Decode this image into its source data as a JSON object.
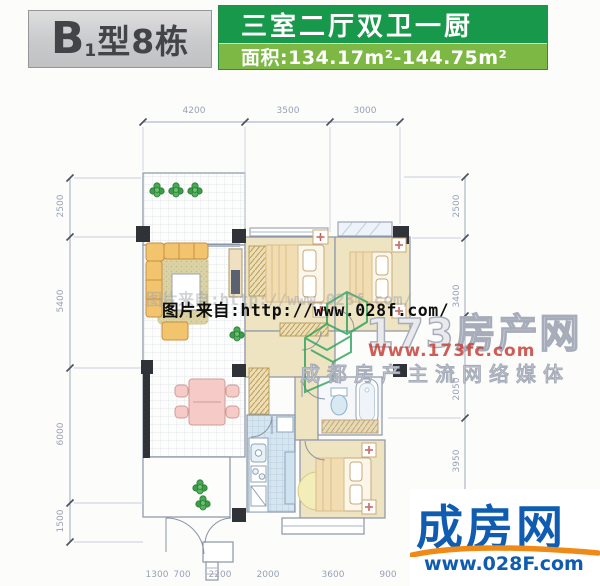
{
  "header": {
    "type_prefix": "B",
    "type_sub": "1",
    "type_suffix": "型8栋",
    "layout_title": "三室二厅双卫一厨",
    "area_label": "面积:134.17m²-144.75m²"
  },
  "dimensions": {
    "top": [
      "4200",
      "3500",
      "3000"
    ],
    "left": [
      "2500",
      "5400",
      "6000",
      "1500"
    ],
    "right": [
      "2500",
      "3400",
      "2050",
      "3950"
    ],
    "bottom": [
      "1300",
      "700",
      "2200",
      "2000",
      "3600",
      "900"
    ]
  },
  "watermarks": {
    "photo_source": "图片来自:http://www.028f.com/",
    "portal_name": "173房产网",
    "portal_url": "Www.173fc.com",
    "portal_slogan": "成都房产主流网络媒体"
  },
  "logo": {
    "name": "成房网",
    "url": "www.028F.com"
  },
  "colors": {
    "header_green_dark": "#18984b",
    "header_green_light": "#7cb843",
    "header_gray": "#c9cacc",
    "logo_blue": "#0f5cb0",
    "logo_orange": "#ef8a16",
    "watermark_red": "#c8413a",
    "watermark_green": "#2ca35c",
    "bedroom_floor": "#efe4c1",
    "kitchen_tile": "#d7e5f0",
    "wall_dark": "#2f3237"
  },
  "icons": {
    "plant": "green-circle-cluster",
    "nightstand_flower": "red-cross-flower",
    "column": "filled-black-square",
    "door": "quarter-arc"
  }
}
